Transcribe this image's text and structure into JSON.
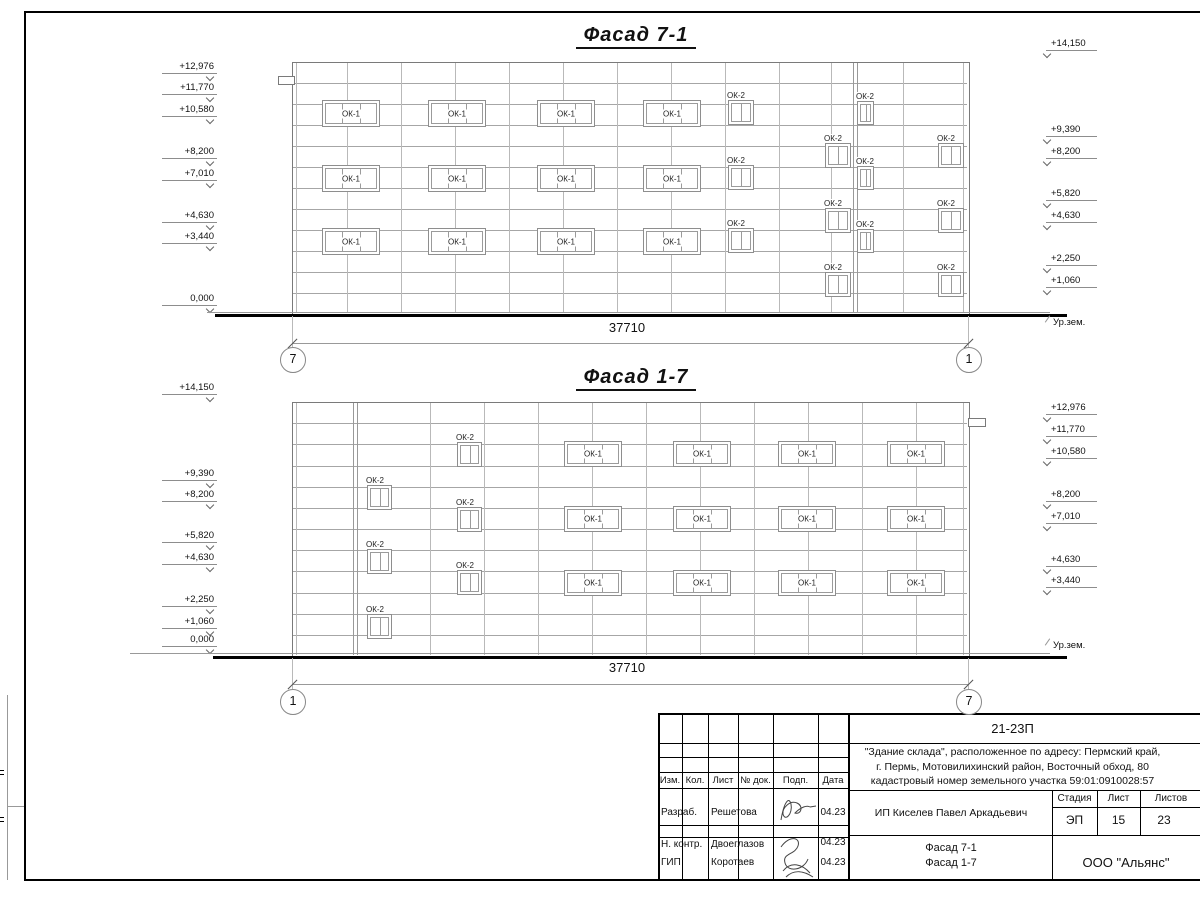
{
  "facades": [
    {
      "id": "facade-7-1",
      "title": "Фасад 7-1",
      "title_cx": 636,
      "title_y": 25,
      "building": {
        "x": 292,
        "y": 62,
        "w": 676,
        "h": 252,
        "bands": 12,
        "verticals": [
          347,
          401,
          455,
          509,
          563,
          617,
          671,
          725,
          779,
          831,
          903
        ],
        "double_verticals": [
          853,
          857
        ]
      },
      "ledge": {
        "x": 278,
        "y": 76,
        "w": 15,
        "h": 7
      },
      "windows": [
        {
          "label": "ОК-1",
          "panes": 3,
          "w": 56,
          "h": 25,
          "label_inside": true,
          "at": [
            [
              322,
              100
            ],
            [
              428,
              100
            ],
            [
              537,
              100
            ],
            [
              643,
              100
            ],
            [
              322,
              165
            ],
            [
              428,
              165
            ],
            [
              537,
              165
            ],
            [
              643,
              165
            ],
            [
              322,
              228
            ],
            [
              428,
              228
            ],
            [
              537,
              228
            ],
            [
              643,
              228
            ]
          ]
        },
        {
          "label": "ОК-2",
          "panes": 2,
          "w": 24,
          "h": 23,
          "label_inside": false,
          "at": [
            [
              728,
              100
            ],
            [
              728,
              165
            ],
            [
              728,
              228
            ],
            [
              825,
              143
            ],
            [
              825,
              208
            ],
            [
              825,
              272
            ],
            [
              938,
              143
            ],
            [
              938,
              208
            ],
            [
              938,
              272
            ]
          ]
        },
        {
          "label": "ОК-2",
          "panes": 2,
          "w": 15,
          "h": 22,
          "label_inside": false,
          "at": [
            [
              857,
              101
            ],
            [
              857,
              166
            ],
            [
              857,
              229
            ]
          ]
        }
      ],
      "left_marks": [
        [
          "+12,976",
          73
        ],
        [
          "+11,770",
          94
        ],
        [
          "+10,580",
          116
        ],
        [
          "+8,200",
          158
        ],
        [
          "+7,010",
          180
        ],
        [
          "+4,630",
          222
        ],
        [
          "+3,440",
          243
        ],
        [
          "0,000",
          305
        ]
      ],
      "right_marks": [
        [
          "+14,150",
          50
        ],
        [
          "+9,390",
          136
        ],
        [
          "+8,200",
          158
        ],
        [
          "+5,820",
          200
        ],
        [
          "+4,630",
          222
        ],
        [
          "+2,250",
          265
        ],
        [
          "+1,060",
          287
        ]
      ],
      "ground": {
        "thin": {
          "x1": 207,
          "x2": 1050,
          "y": 312
        },
        "thick": {
          "x1": 215,
          "x2": 1067,
          "y": 314
        }
      },
      "ground_label": {
        "text": "Ур.зем.",
        "x": 1053,
        "y": 317
      },
      "dimension": {
        "text": "37710",
        "tx": 627,
        "ty": 321,
        "line_y": 343,
        "x1": 292,
        "x2": 968
      },
      "axes": [
        {
          "label": "7",
          "cx": 292,
          "cy": 359
        },
        {
          "label": "1",
          "cx": 968,
          "cy": 359
        }
      ]
    },
    {
      "id": "facade-1-7",
      "title": "Фасад 1-7",
      "title_cx": 636,
      "title_y": 367,
      "building": {
        "x": 292,
        "y": 402,
        "w": 676,
        "h": 254,
        "bands": 12,
        "verticals": [
          430,
          484,
          538,
          592,
          646,
          700,
          754,
          808,
          862,
          916
        ],
        "double_verticals": [
          353,
          357
        ]
      },
      "ledge": {
        "x": 968,
        "y": 418,
        "w": 16,
        "h": 7
      },
      "windows": [
        {
          "label": "ОК-2",
          "panes": 2,
          "w": 23,
          "h": 23,
          "label_inside": false,
          "at": [
            [
              367,
              485
            ],
            [
              367,
              549
            ],
            [
              367,
              614
            ],
            [
              457,
              442
            ],
            [
              457,
              507
            ],
            [
              457,
              570
            ]
          ]
        },
        {
          "label": "ОК-1",
          "panes": 3,
          "w": 56,
          "h": 24,
          "label_inside": true,
          "at": [
            [
              564,
              441
            ],
            [
              673,
              441
            ],
            [
              778,
              441
            ],
            [
              887,
              441
            ],
            [
              564,
              506
            ],
            [
              673,
              506
            ],
            [
              778,
              506
            ],
            [
              887,
              506
            ],
            [
              564,
              570
            ],
            [
              673,
              570
            ],
            [
              778,
              570
            ],
            [
              887,
              570
            ]
          ]
        }
      ],
      "left_marks": [
        [
          "+14,150",
          394
        ],
        [
          "+9,390",
          480
        ],
        [
          "+8,200",
          501
        ],
        [
          "+5,820",
          542
        ],
        [
          "+4,630",
          564
        ],
        [
          "+2,250",
          606
        ],
        [
          "+1,060",
          628
        ],
        [
          "0,000",
          646
        ]
      ],
      "right_marks": [
        [
          "+12,976",
          414
        ],
        [
          "+11,770",
          436
        ],
        [
          "+10,580",
          458
        ],
        [
          "+8,200",
          501
        ],
        [
          "+7,010",
          523
        ],
        [
          "+4,630",
          566
        ],
        [
          "+3,440",
          587
        ]
      ],
      "ground": {
        "thin": {
          "x1": 130,
          "x2": 1050,
          "y": 653
        },
        "thick": {
          "x1": 213,
          "x2": 1067,
          "y": 656
        }
      },
      "ground_label": {
        "text": "Ур.зем.",
        "x": 1053,
        "y": 640
      },
      "dimension": {
        "text": "37710",
        "tx": 627,
        "ty": 661,
        "line_y": 684,
        "x1": 292,
        "x2": 968
      },
      "axes": [
        {
          "label": "1",
          "cx": 292,
          "cy": 701
        },
        {
          "label": "7",
          "cx": 968,
          "cy": 701
        }
      ]
    }
  ],
  "title_block": {
    "code": "21-23П",
    "desc1": "\"Здание склада\", расположенное по адресу: Пермский край,",
    "desc2": "г. Пермь, Мотовилихинский район, Восточный обход, 80",
    "desc3": "кадастровый номер земельного участка 59:01:0910028:57",
    "client": "ИП Киселев Павел Аркадьевич",
    "cols": {
      "izm": "Изм.",
      "kol": "Кол.",
      "list": "Лист",
      "ndok": "№ док.",
      "podp": "Подп.",
      "data": "Дата"
    },
    "rows": [
      {
        "role": "Разраб.",
        "name": "Решетова",
        "date": "04.23"
      },
      {
        "role": "Н. контр.",
        "name": "Двоеглазов",
        "date": "04.23"
      },
      {
        "role": "ГИП",
        "name": "Коротаев",
        "date": "04.23"
      }
    ],
    "stage": {
      "h1": "Стадия",
      "h2": "Лист",
      "h3": "Листов",
      "v1": "ЭП",
      "v2": "15",
      "v3": "23"
    },
    "sheet1": "Фасад 7-1",
    "sheet2": "Фасад 1-7",
    "company": "ООО \"Альянс\""
  }
}
